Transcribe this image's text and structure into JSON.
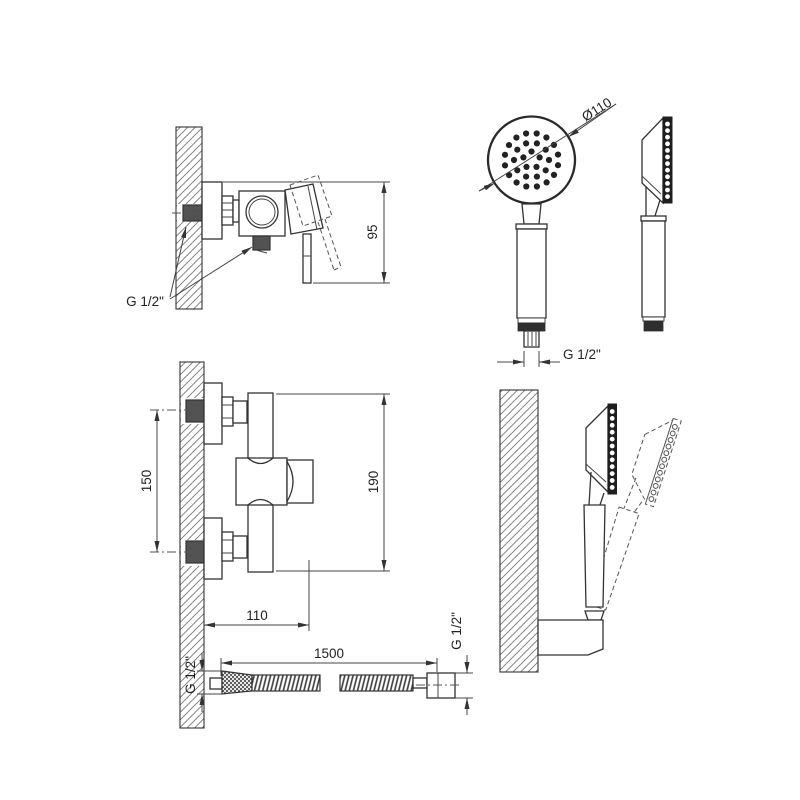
{
  "drawing": {
    "type": "technical-drawing",
    "subject": "wall-mounted shower mixer with hand shower, holder and hose",
    "background_color": "#ffffff",
    "line_color": "#333333",
    "labels": {
      "mixer_side": {
        "thread": "G 1/2\"",
        "height": "95"
      },
      "handshower": {
        "diameter": "Ø110",
        "thread": "G 1/2\""
      },
      "mixer_front": {
        "spacing": "150",
        "height": "190",
        "width": "110"
      },
      "hose": {
        "length": "1500",
        "thread_left": "G 1/2\"",
        "thread_right": "G 1/2\""
      }
    }
  }
}
